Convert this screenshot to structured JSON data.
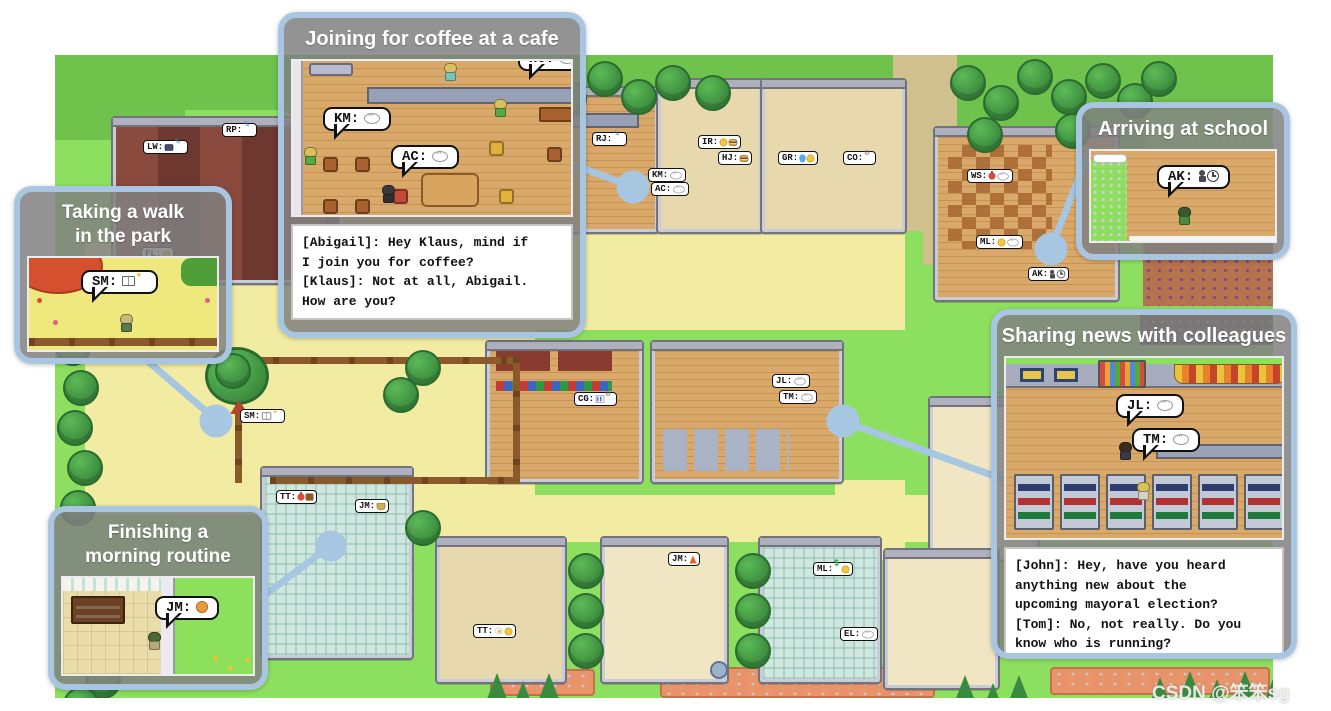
{
  "watermark": {
    "text": "CSDN @笨笨sg"
  },
  "colors": {
    "callout_border": "#a8c6e2",
    "callout_header": "#8a8a8a",
    "leader_line": "#a6c6e2",
    "map_grass": "#8de05f",
    "path_yellow": "#f2eca3"
  },
  "callouts": {
    "cafe": {
      "title": "Joining for coffee at a cafe",
      "dialogue": "[Abigail]: Hey Klaus, mind if\nI join you for coffee?\n[Klaus]: Not at all, Abigail.\nHow are you?",
      "bubbles": [
        {
          "code": "KM:",
          "icons": [
            "chat"
          ]
        },
        {
          "code": "AC:",
          "icons": [
            "chat"
          ]
        },
        {
          "code": "HU:",
          "icons": [
            "chat"
          ]
        }
      ]
    },
    "park": {
      "title": "Taking a walk\nin the park",
      "bubble": {
        "code": "SM:",
        "icons": [
          "book",
          "sparkle"
        ]
      }
    },
    "school": {
      "title": "Arriving at school",
      "bubble": {
        "code": "AK:",
        "icons": [
          "figure",
          "clock"
        ]
      }
    },
    "news": {
      "title": "Sharing news with colleagues",
      "dialogue": "[John]: Hey, have you heard\nanything new about the\nupcoming mayoral election?\n[Tom]: No, not really. Do you\nknow who is running?",
      "bubbles": [
        {
          "code": "JL:",
          "icons": [
            "chat"
          ]
        },
        {
          "code": "TM:",
          "icons": [
            "chat"
          ]
        }
      ]
    },
    "routine": {
      "title": "Finishing a\nmorning routine",
      "bubble": {
        "code": "JM:",
        "icons": [
          "cat"
        ]
      }
    }
  },
  "map": {
    "chips": [
      {
        "code": "LW:",
        "icons": [
          "case",
          "pencil"
        ],
        "x": 88,
        "y": 85
      },
      {
        "code": "RP:",
        "icons": [
          "pencil"
        ],
        "x": 167,
        "y": 68
      },
      {
        "code": "FL:",
        "icons": [
          "coin"
        ],
        "x": 86,
        "y": 192
      },
      {
        "code": "RJ:",
        "icons": [
          "pencil"
        ],
        "x": 537,
        "y": 77
      },
      {
        "code": "IR:",
        "icons": [
          "smile",
          "burger"
        ],
        "x": 643,
        "y": 80
      },
      {
        "code": "HJ:",
        "icons": [
          "burger"
        ],
        "x": 663,
        "y": 96
      },
      {
        "code": "GR:",
        "icons": [
          "drop",
          "coin"
        ],
        "x": 723,
        "y": 96
      },
      {
        "code": "CO:",
        "icons": [
          "tool"
        ],
        "x": 788,
        "y": 96
      },
      {
        "code": "KM:",
        "icons": [
          "chat"
        ],
        "x": 593,
        "y": 113
      },
      {
        "code": "AC:",
        "icons": [
          "chat"
        ],
        "x": 596,
        "y": 127
      },
      {
        "code": "WS:",
        "icons": [
          "apple",
          "chat"
        ],
        "x": 912,
        "y": 114
      },
      {
        "code": "ML:",
        "icons": [
          "coin",
          "chat"
        ],
        "x": 921,
        "y": 180
      },
      {
        "code": "AK:",
        "icons": [
          "figure",
          "clock"
        ],
        "x": 973,
        "y": 212
      },
      {
        "code": "SM:",
        "icons": [
          "book",
          "sparkle"
        ],
        "x": 185,
        "y": 354
      },
      {
        "code": "CG:",
        "icons": [
          "chart",
          "tool"
        ],
        "x": 519,
        "y": 337
      },
      {
        "code": "JL:",
        "icons": [
          "chat"
        ],
        "x": 717,
        "y": 319
      },
      {
        "code": "TM:",
        "icons": [
          "chat"
        ],
        "x": 724,
        "y": 335
      },
      {
        "code": "TT:",
        "icons": [
          "apple",
          "bag"
        ],
        "x": 221,
        "y": 435
      },
      {
        "code": "JM:",
        "icons": [
          "basket"
        ],
        "x": 300,
        "y": 444
      },
      {
        "code": "TT:",
        "icons": [
          "egg",
          "coin"
        ],
        "x": 418,
        "y": 569
      },
      {
        "code": "JM:",
        "icons": [
          "fire"
        ],
        "x": 613,
        "y": 497
      },
      {
        "code": "ML:",
        "icons": [
          "dollar",
          "coin"
        ],
        "x": 758,
        "y": 507
      },
      {
        "code": "EL:",
        "icons": [
          "chat"
        ],
        "x": 785,
        "y": 572
      }
    ]
  }
}
